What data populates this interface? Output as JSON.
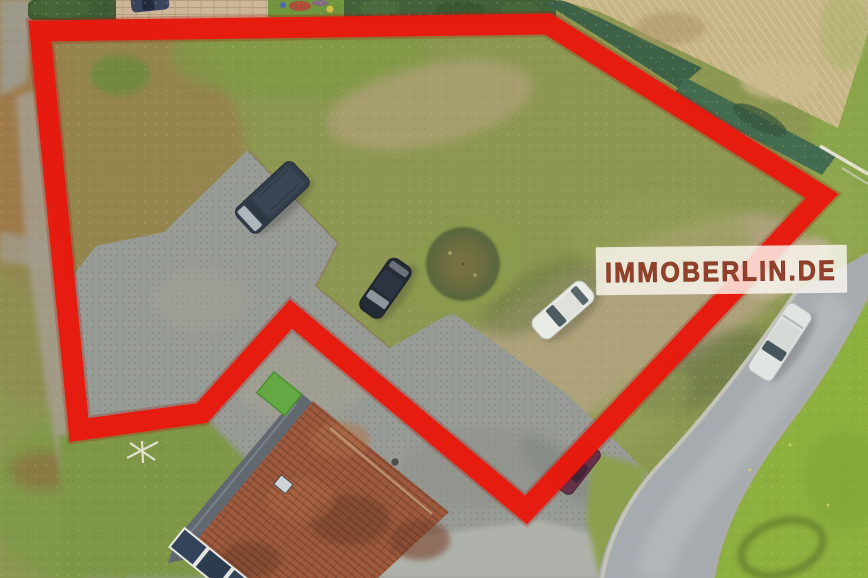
{
  "page": {
    "title": "Aerial drone photo of building plot with boundary overlay"
  },
  "photo": {
    "kind": "aerial-drone-photo",
    "palette": {
      "grass_base": "#8c9751",
      "grass_bright": "#8db13e",
      "dry_grass": "#97804e",
      "dirt": "#b4a483",
      "pavement": "#989c96",
      "road": "#a6abaf",
      "roof_tiles": "#9e5a3e",
      "hedge": "#40613a"
    }
  },
  "overlay": {
    "boundary_color": "#e8190d",
    "boundary_shadow_color": "#a31106",
    "boundary_stroke_px": 21,
    "boundary_shadow_px": 26,
    "boundary_points": "40,31 548,24 822,196 526,510 291,314 202,413 79,430"
  },
  "watermark": {
    "text": "IMMOBERLIN.DE",
    "text_color": "#94412c",
    "text_outline": "#6f2413",
    "panel_color": "rgba(251,248,240,0.82)"
  }
}
